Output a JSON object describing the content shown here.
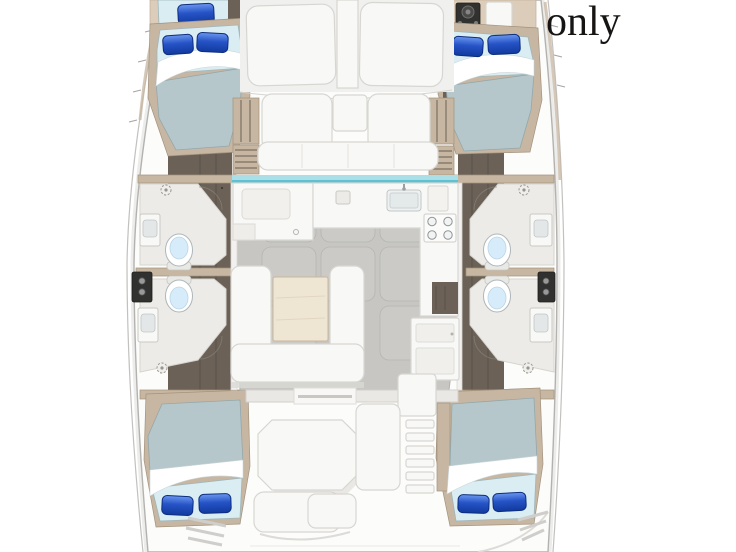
{
  "caption": {
    "text": "only"
  },
  "colors": {
    "page_bg": "#ffffff",
    "hull_fill": "#fcfcfb",
    "hull_outline": "#b3b2af",
    "hull_shadow": "#ececea",
    "deck_panel": "#f0f0ee",
    "wood_floor": "#6b6156",
    "wood_floor_dark": "#554e46",
    "wood_trim": "#c7b6a2",
    "wood_trim_light": "#dbcdba",
    "bathroom_floor": "#edebe7",
    "mattress": "#b5c7ca",
    "mattress_head": "#d9edf2",
    "pillow_light": "#6a97ef",
    "pillow_mid": "#2653c6",
    "pillow_dark": "#113a9e",
    "pillow_stroke": "#0d2d7e",
    "sheet": "#ffffff",
    "salon_floor": "#c7c6c2",
    "tile_fill": "#cbcac6",
    "tile_stroke": "#b6b5b1",
    "furniture_white": "#f8f8f6",
    "furniture_stroke": "#d7d6d2",
    "table_wood": "#efe5d3",
    "table_stroke": "#c8b79e",
    "windshield_teal": "#5fc0d2",
    "toilet_bowl": "#d6ecfa",
    "dark_panel": "#31312f",
    "caption_color": "#161514"
  }
}
